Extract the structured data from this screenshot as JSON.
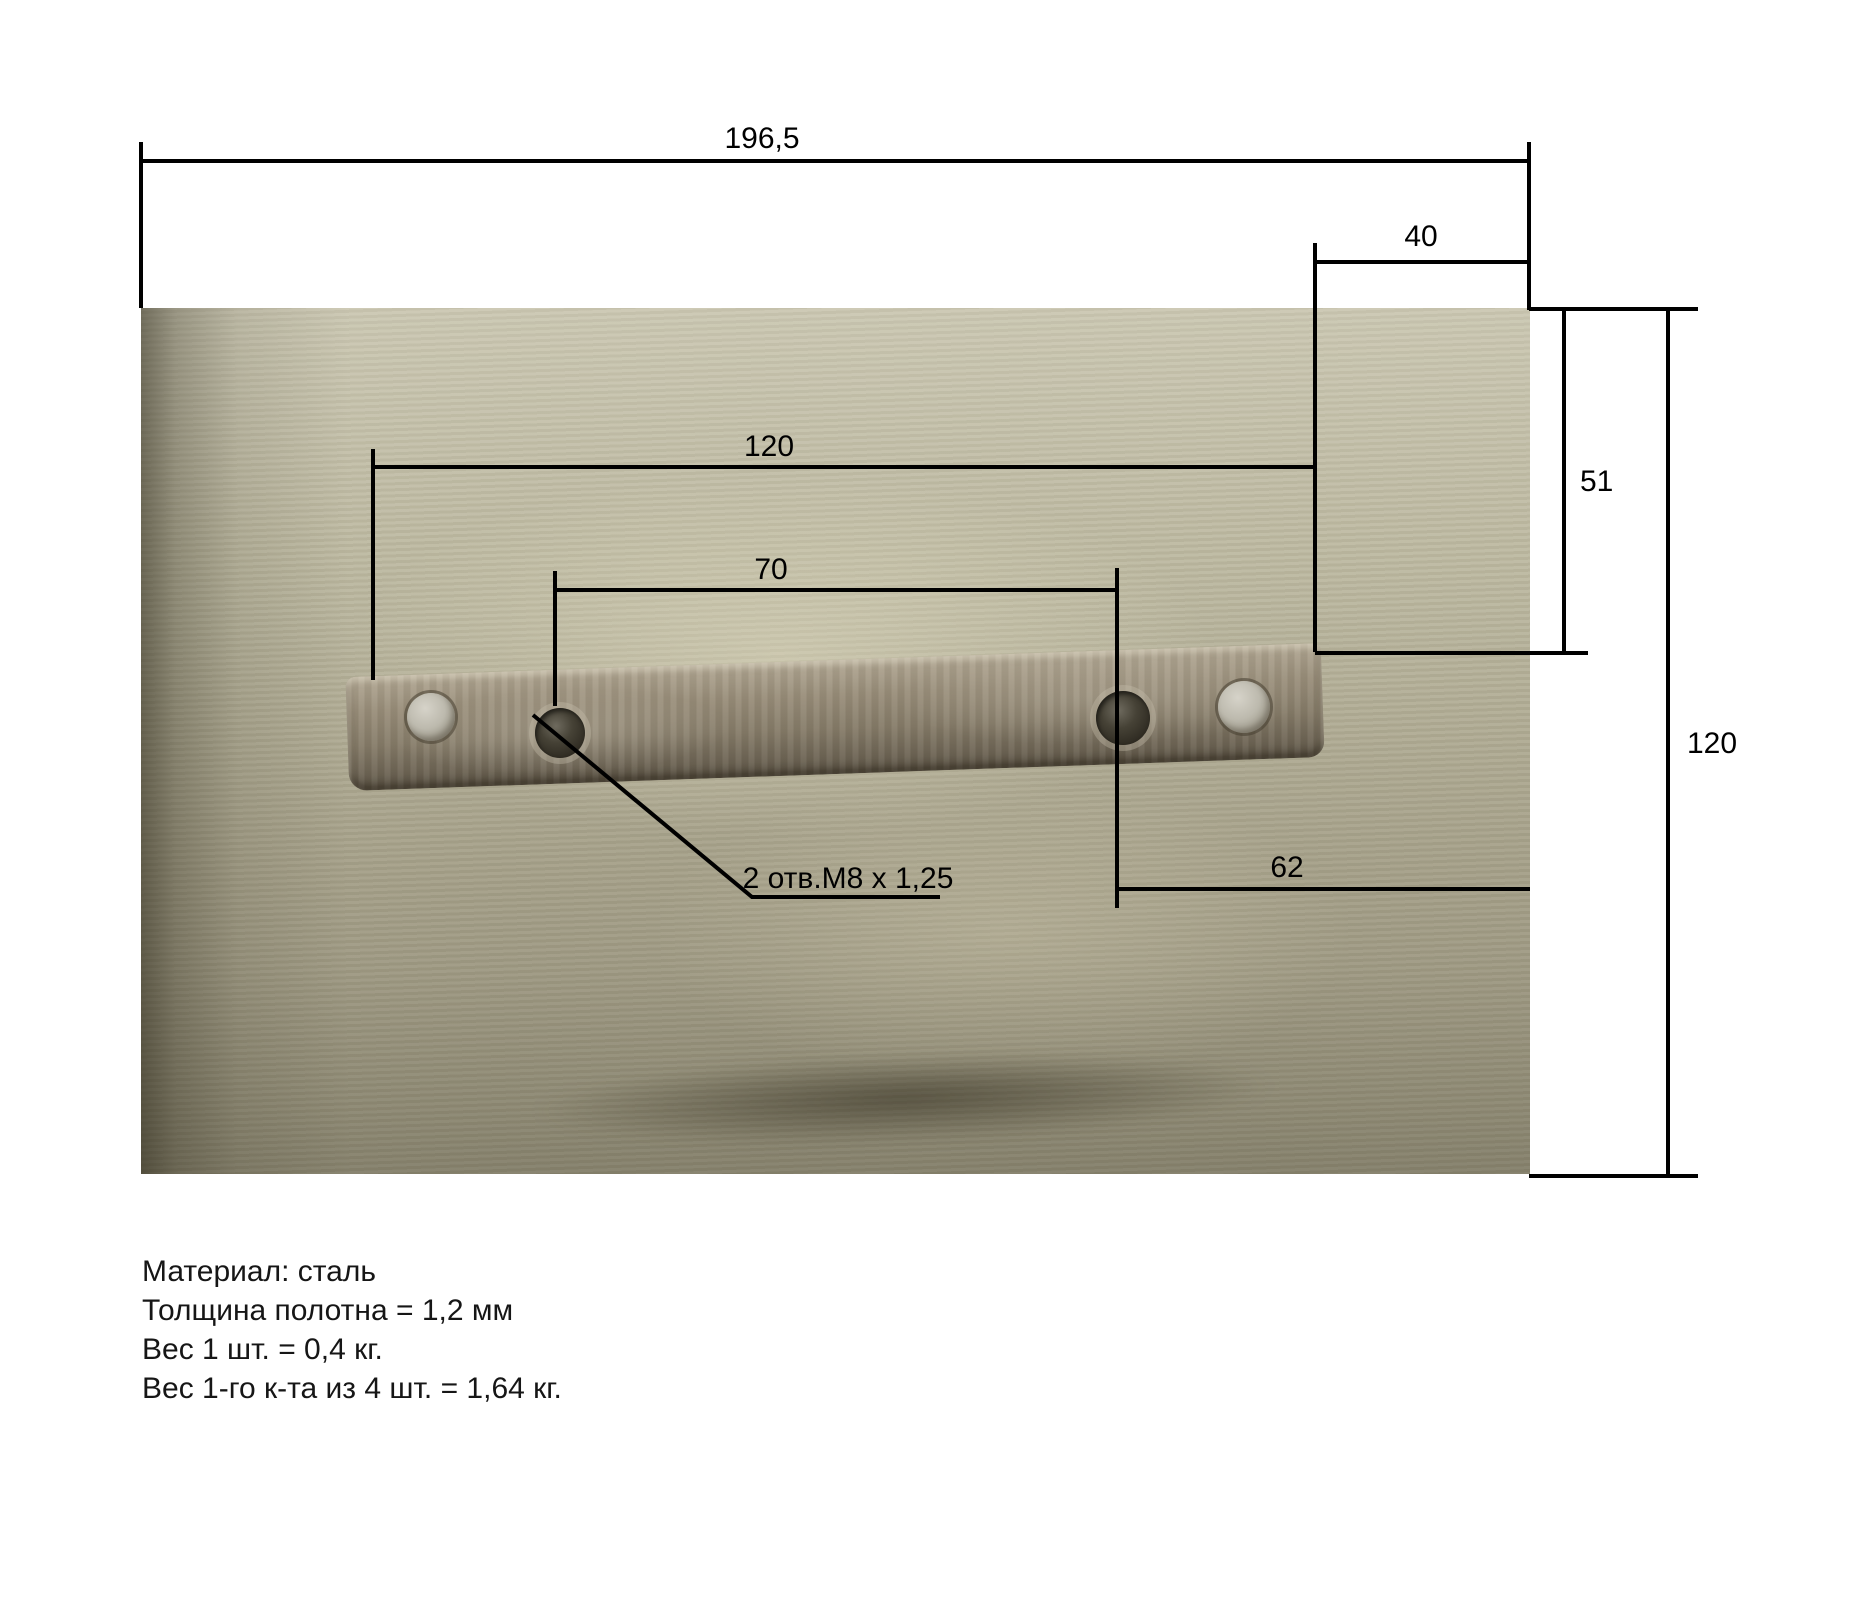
{
  "drawing": {
    "dims": {
      "total_width": "196,5",
      "right_offset": "40",
      "bar_length": "120",
      "hole_spacing": "70",
      "top_to_bar": "51",
      "hole_to_edge": "62",
      "plate_height": "120"
    },
    "leader": {
      "label": "2 отв.М8 х 1,25"
    },
    "notes": [
      "Материал: сталь",
      "Толщина полотна = 1,2 мм",
      "Вес 1 шт. = 0,4 кг.",
      "Вес 1-го к-та из 4 шт. = 1,64 кг."
    ],
    "colors": {
      "line": "#000000",
      "photo_base": "#b5b19a",
      "bar": "#867c69",
      "background": "#ffffff"
    }
  }
}
